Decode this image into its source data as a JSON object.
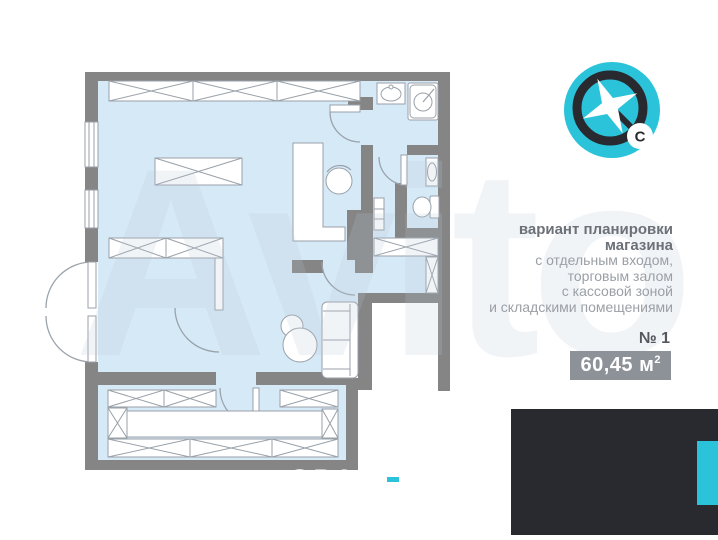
{
  "compass": {
    "north_label": "С"
  },
  "description": {
    "title_line1": "вариант планировки",
    "title_line2": "магазина",
    "line1": "с отдельным входом,",
    "line2": "торговым залом",
    "line3": "с кассовой зоной",
    "line4": "и складскими помещениями"
  },
  "plan_number": "№ 1",
  "area": {
    "value": "60,45",
    "unit": "м",
    "superscript": "2"
  },
  "logo": {
    "text_main": "SPAC"
  },
  "watermark": {
    "text": "Avito"
  },
  "colors": {
    "accent_cyan": "#2bc3d9",
    "wall_gray": "#858585",
    "floor_blue": "#d6e9f7",
    "logo_dark": "#292930",
    "badge_gray": "#8d9299"
  }
}
